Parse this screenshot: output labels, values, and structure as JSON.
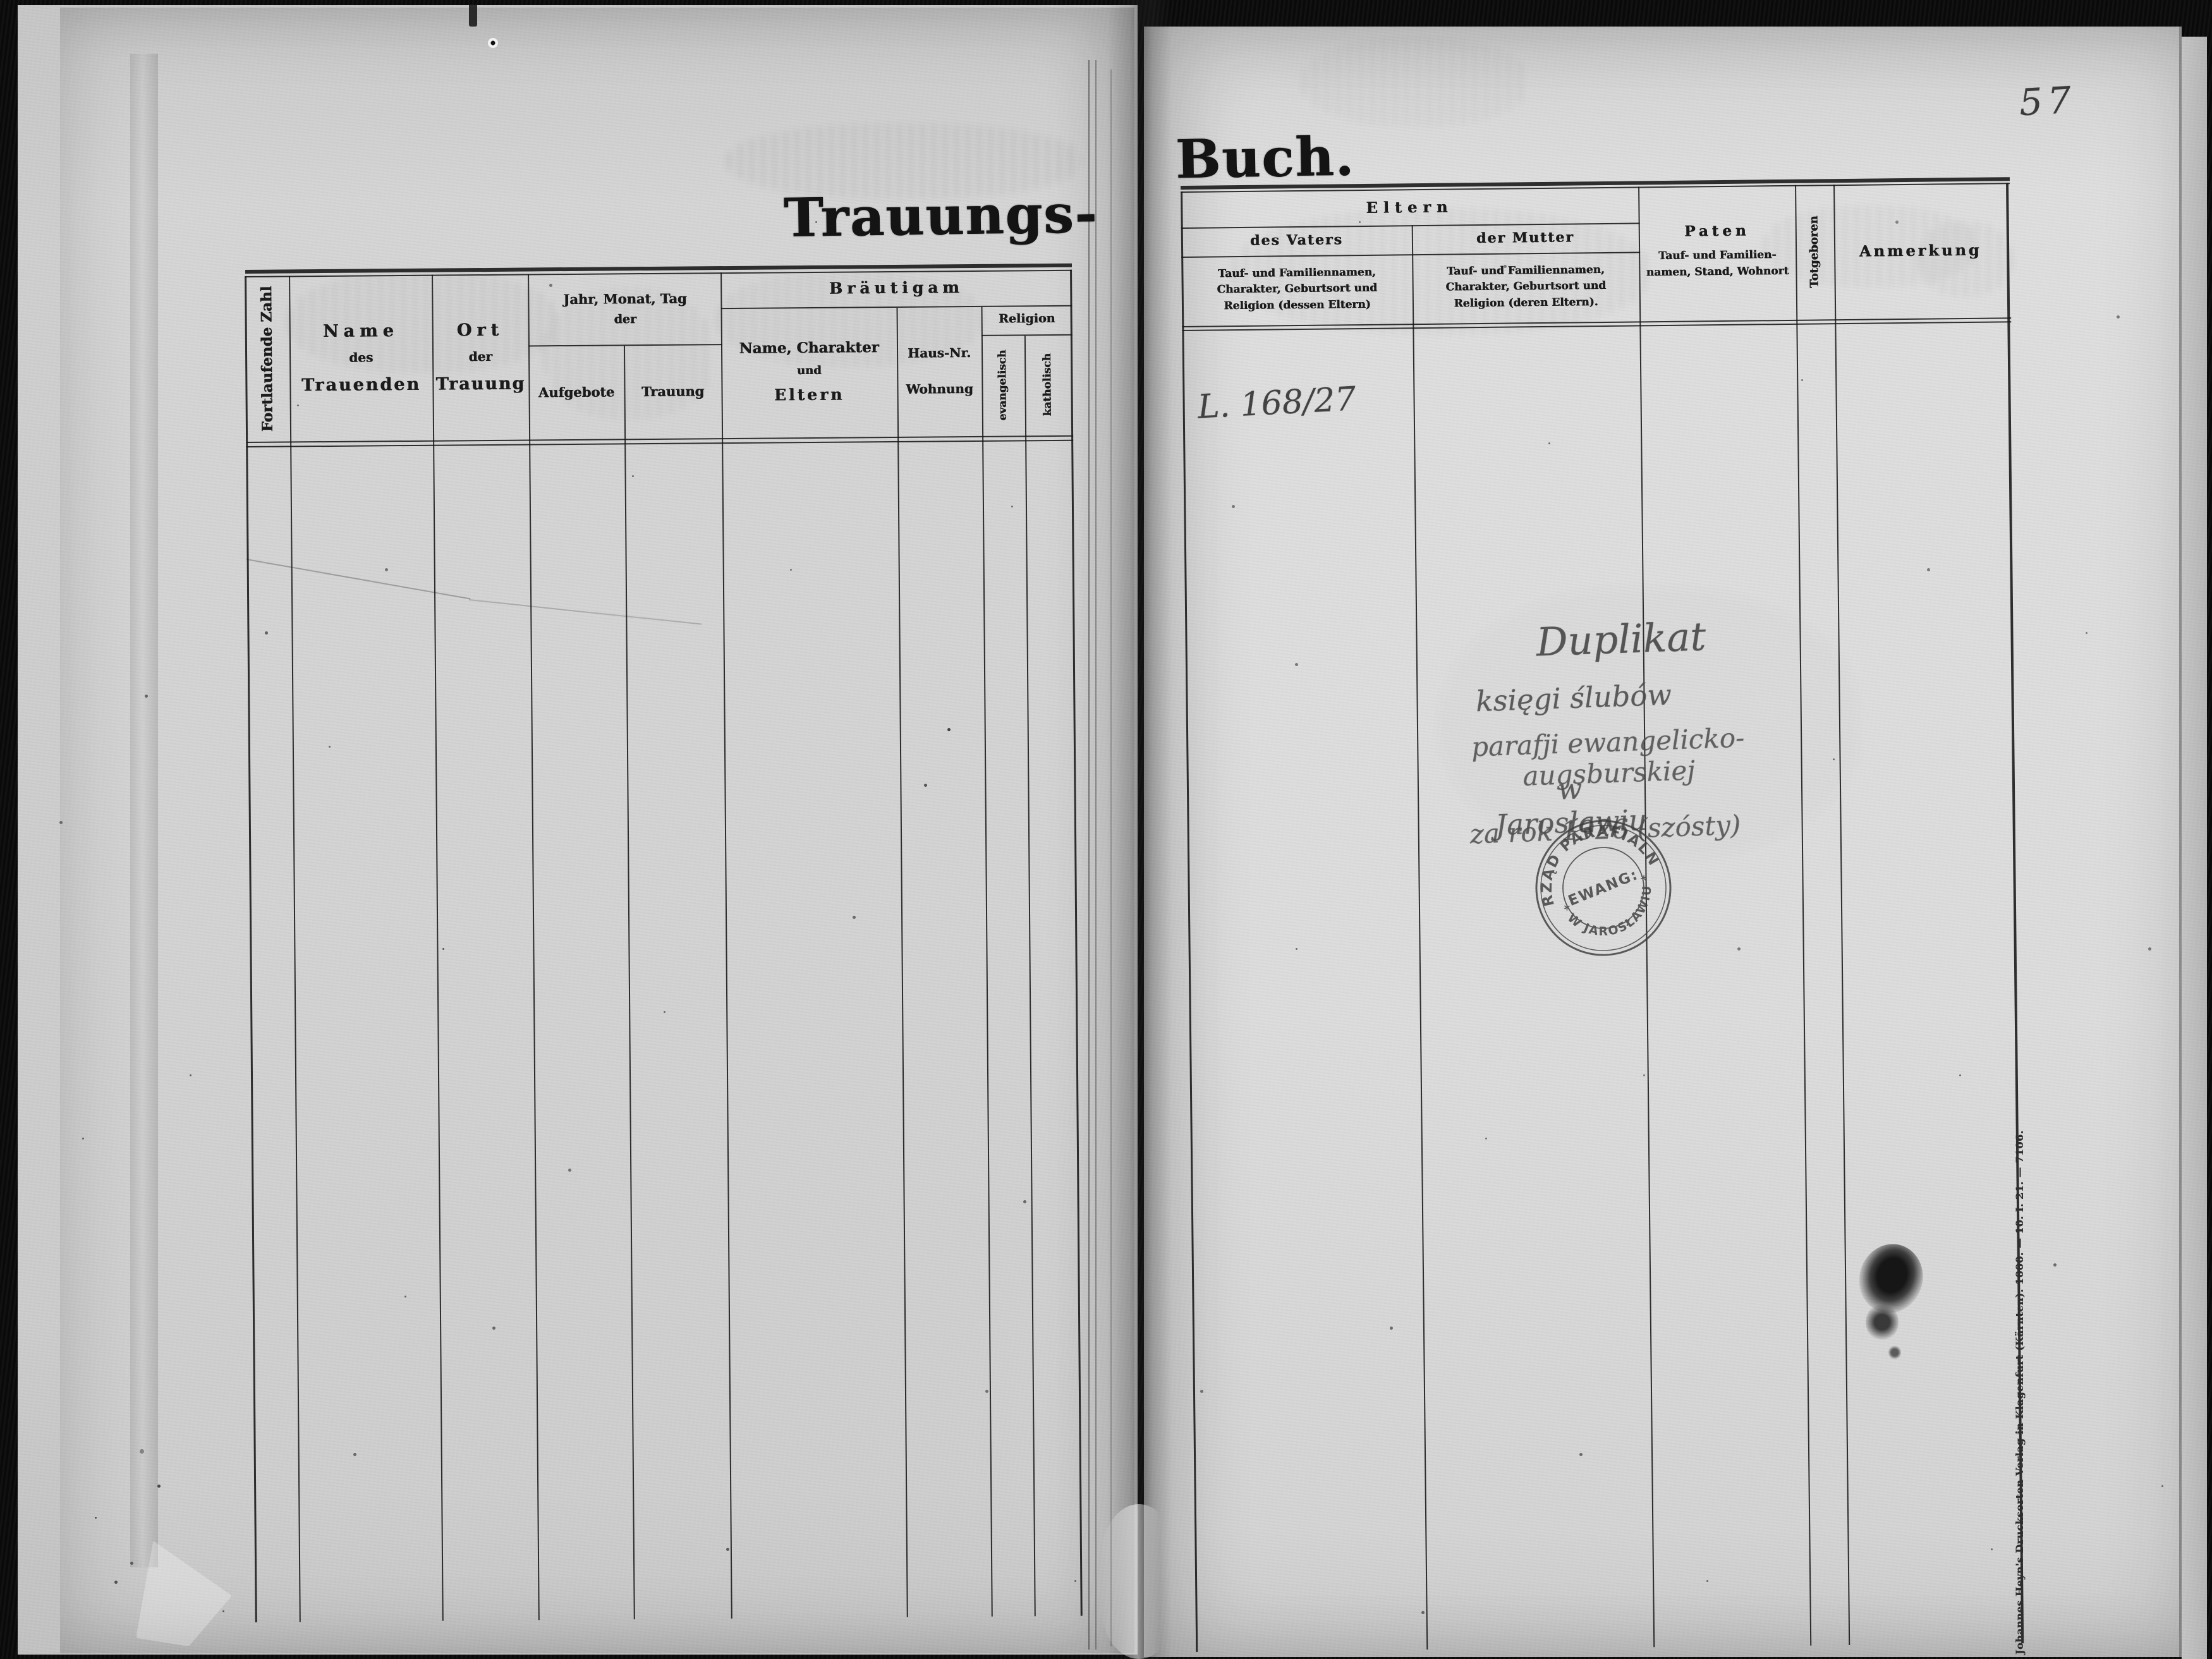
{
  "scan": {
    "page_number": "57",
    "left_page": {
      "title": "Trauungs-",
      "header": {
        "serial": "Fortlaufende Zahl",
        "name": [
          "Name",
          "des",
          "Trauenden"
        ],
        "place": [
          "Ort",
          "der",
          "Trauung"
        ],
        "date": {
          "group": [
            "Jahr, Monat, Tag",
            "der"
          ],
          "banns": "Aufgebote",
          "wedding": "Trauung"
        },
        "groom": {
          "label": "Bräutigam",
          "name_character": [
            "Name, Charakter",
            "und",
            "Eltern"
          ],
          "house": [
            "Haus-Nr.",
            "Wohnung"
          ],
          "religion": {
            "label": "Religion",
            "protestant": "evangelisch",
            "catholic": "katholisch"
          }
        }
      }
    },
    "right_page": {
      "title": "Buch.",
      "header": {
        "parents": {
          "label": "Eltern",
          "father": {
            "label": "des Vaters",
            "desc": [
              "Tauf- und Familiennamen,",
              "Charakter, Geburtsort und",
              "Religion (dessen Eltern)"
            ]
          },
          "mother": {
            "label": "der Mutter",
            "desc": [
              "Tauf- und Familiennamen,",
              "Charakter, Geburtsort und",
              "Religion (deren Eltern)."
            ]
          }
        },
        "godparents": {
          "label": "Paten",
          "desc": [
            "Tauf- und Familien-",
            "namen, Stand, Wohnort"
          ]
        },
        "stillborn": "Totgeboren",
        "remark": "Anmerkung"
      },
      "handwriting": {
        "reference": "L. 168/27",
        "note": [
          "Duplikat",
          "księgi ślubów",
          "parafji ewangelicko-augsburskiej",
          "w Jarosławiu",
          "za rok 1926 (szósty)"
        ]
      },
      "stamp": {
        "arc_top": "URZĄD PARAFIALNY",
        "arc_bottom": "* W JAROSŁAWIU *",
        "center": "EWANG:"
      },
      "imprint": "Johannes Heyn's Drucksorten-Verlag in Klagenfurt (Kärnten). 1000. — 10. I. 21. — 7106."
    }
  }
}
